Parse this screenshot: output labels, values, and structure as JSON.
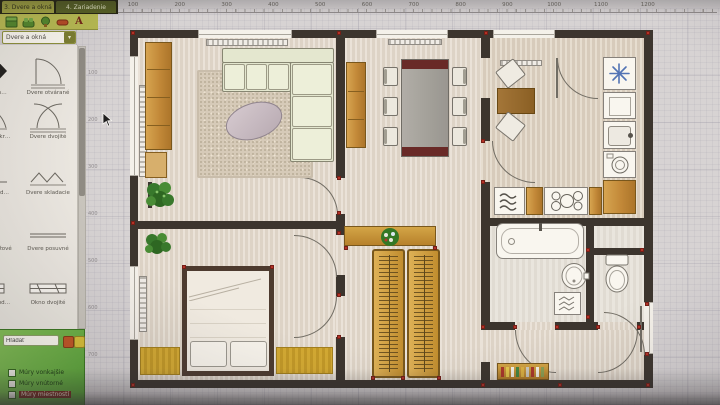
{
  "toolbar": {
    "tabs": [
      {
        "label": "3. Dvere a okná",
        "active": false
      },
      {
        "label": "4. Zariadenie",
        "active": true
      }
    ],
    "tools": [
      "cabinet-tool",
      "sofa-tool",
      "plant-tool",
      "delete-tool",
      "text-tool"
    ],
    "text_glyph": "A"
  },
  "category_dropdown": {
    "value": "Dvere a okná",
    "arrow": "▾"
  },
  "library": {
    "items": [
      {
        "label": "Dvere vch…",
        "symbol": "diamond"
      },
      {
        "label": "Dvere otvárané",
        "symbol": "door-single"
      },
      {
        "label": "Dvere dvojkr…",
        "symbol": "door-double-l"
      },
      {
        "label": "Dvere dvojité",
        "symbol": "door-double"
      },
      {
        "label": "Dvere sklad…",
        "symbol": "fold-single"
      },
      {
        "label": "Dvere skladacie",
        "symbol": "fold-double"
      },
      {
        "label": "Dvere garážové",
        "symbol": "line-thick"
      },
      {
        "label": "Dvere posuvné",
        "symbol": "line-thin"
      },
      {
        "label": "Okno jednod…",
        "symbol": "window-single"
      },
      {
        "label": "Okno dvojité",
        "symbol": "window-double"
      }
    ]
  },
  "layers_panel": {
    "search_value": "Hľadať",
    "checkboxes": [
      {
        "label": "Múry vonkajšie",
        "checked": true,
        "highlight": false
      },
      {
        "label": "Múry vnútorné",
        "checked": true,
        "highlight": false
      },
      {
        "label": "Múry miestností",
        "checked": true,
        "highlight": true
      }
    ]
  },
  "rulers": {
    "horizontal": [
      "100",
      "200",
      "300",
      "400",
      "500",
      "600",
      "700",
      "800",
      "900",
      "1000",
      "1100",
      "1200"
    ],
    "vertical": [
      "100",
      "200",
      "300",
      "400",
      "500",
      "600",
      "700"
    ]
  },
  "floorplan": {
    "colors": {
      "wall": "#3a322b",
      "marker": "#c32a1e",
      "wood": "#c9862a",
      "floor": "#e3dacd",
      "sofa": "#e3e8d0",
      "rug_yellow": "#d9a91f",
      "fixture": "#f8f7f3",
      "table_end": "#6e2522",
      "snowflake": "#4a72c0"
    },
    "markers": [
      [
        131,
        31
      ],
      [
        337,
        31
      ],
      [
        484,
        31
      ],
      [
        646,
        31
      ],
      [
        131,
        221
      ],
      [
        131,
        383
      ],
      [
        646,
        383
      ],
      [
        337,
        176
      ],
      [
        337,
        211
      ],
      [
        337,
        231
      ],
      [
        337,
        293
      ],
      [
        337,
        335
      ],
      [
        182,
        265
      ],
      [
        270,
        265
      ],
      [
        344,
        246
      ],
      [
        433,
        246
      ],
      [
        371,
        376
      ],
      [
        401,
        376
      ],
      [
        437,
        376
      ],
      [
        481,
        139
      ],
      [
        481,
        180
      ],
      [
        586,
        248
      ],
      [
        640,
        248
      ],
      [
        586,
        315
      ],
      [
        481,
        325
      ],
      [
        513,
        325
      ],
      [
        555,
        325
      ],
      [
        596,
        325
      ],
      [
        637,
        325
      ],
      [
        645,
        302
      ],
      [
        645,
        352
      ],
      [
        481,
        383
      ],
      [
        558,
        383
      ]
    ]
  }
}
